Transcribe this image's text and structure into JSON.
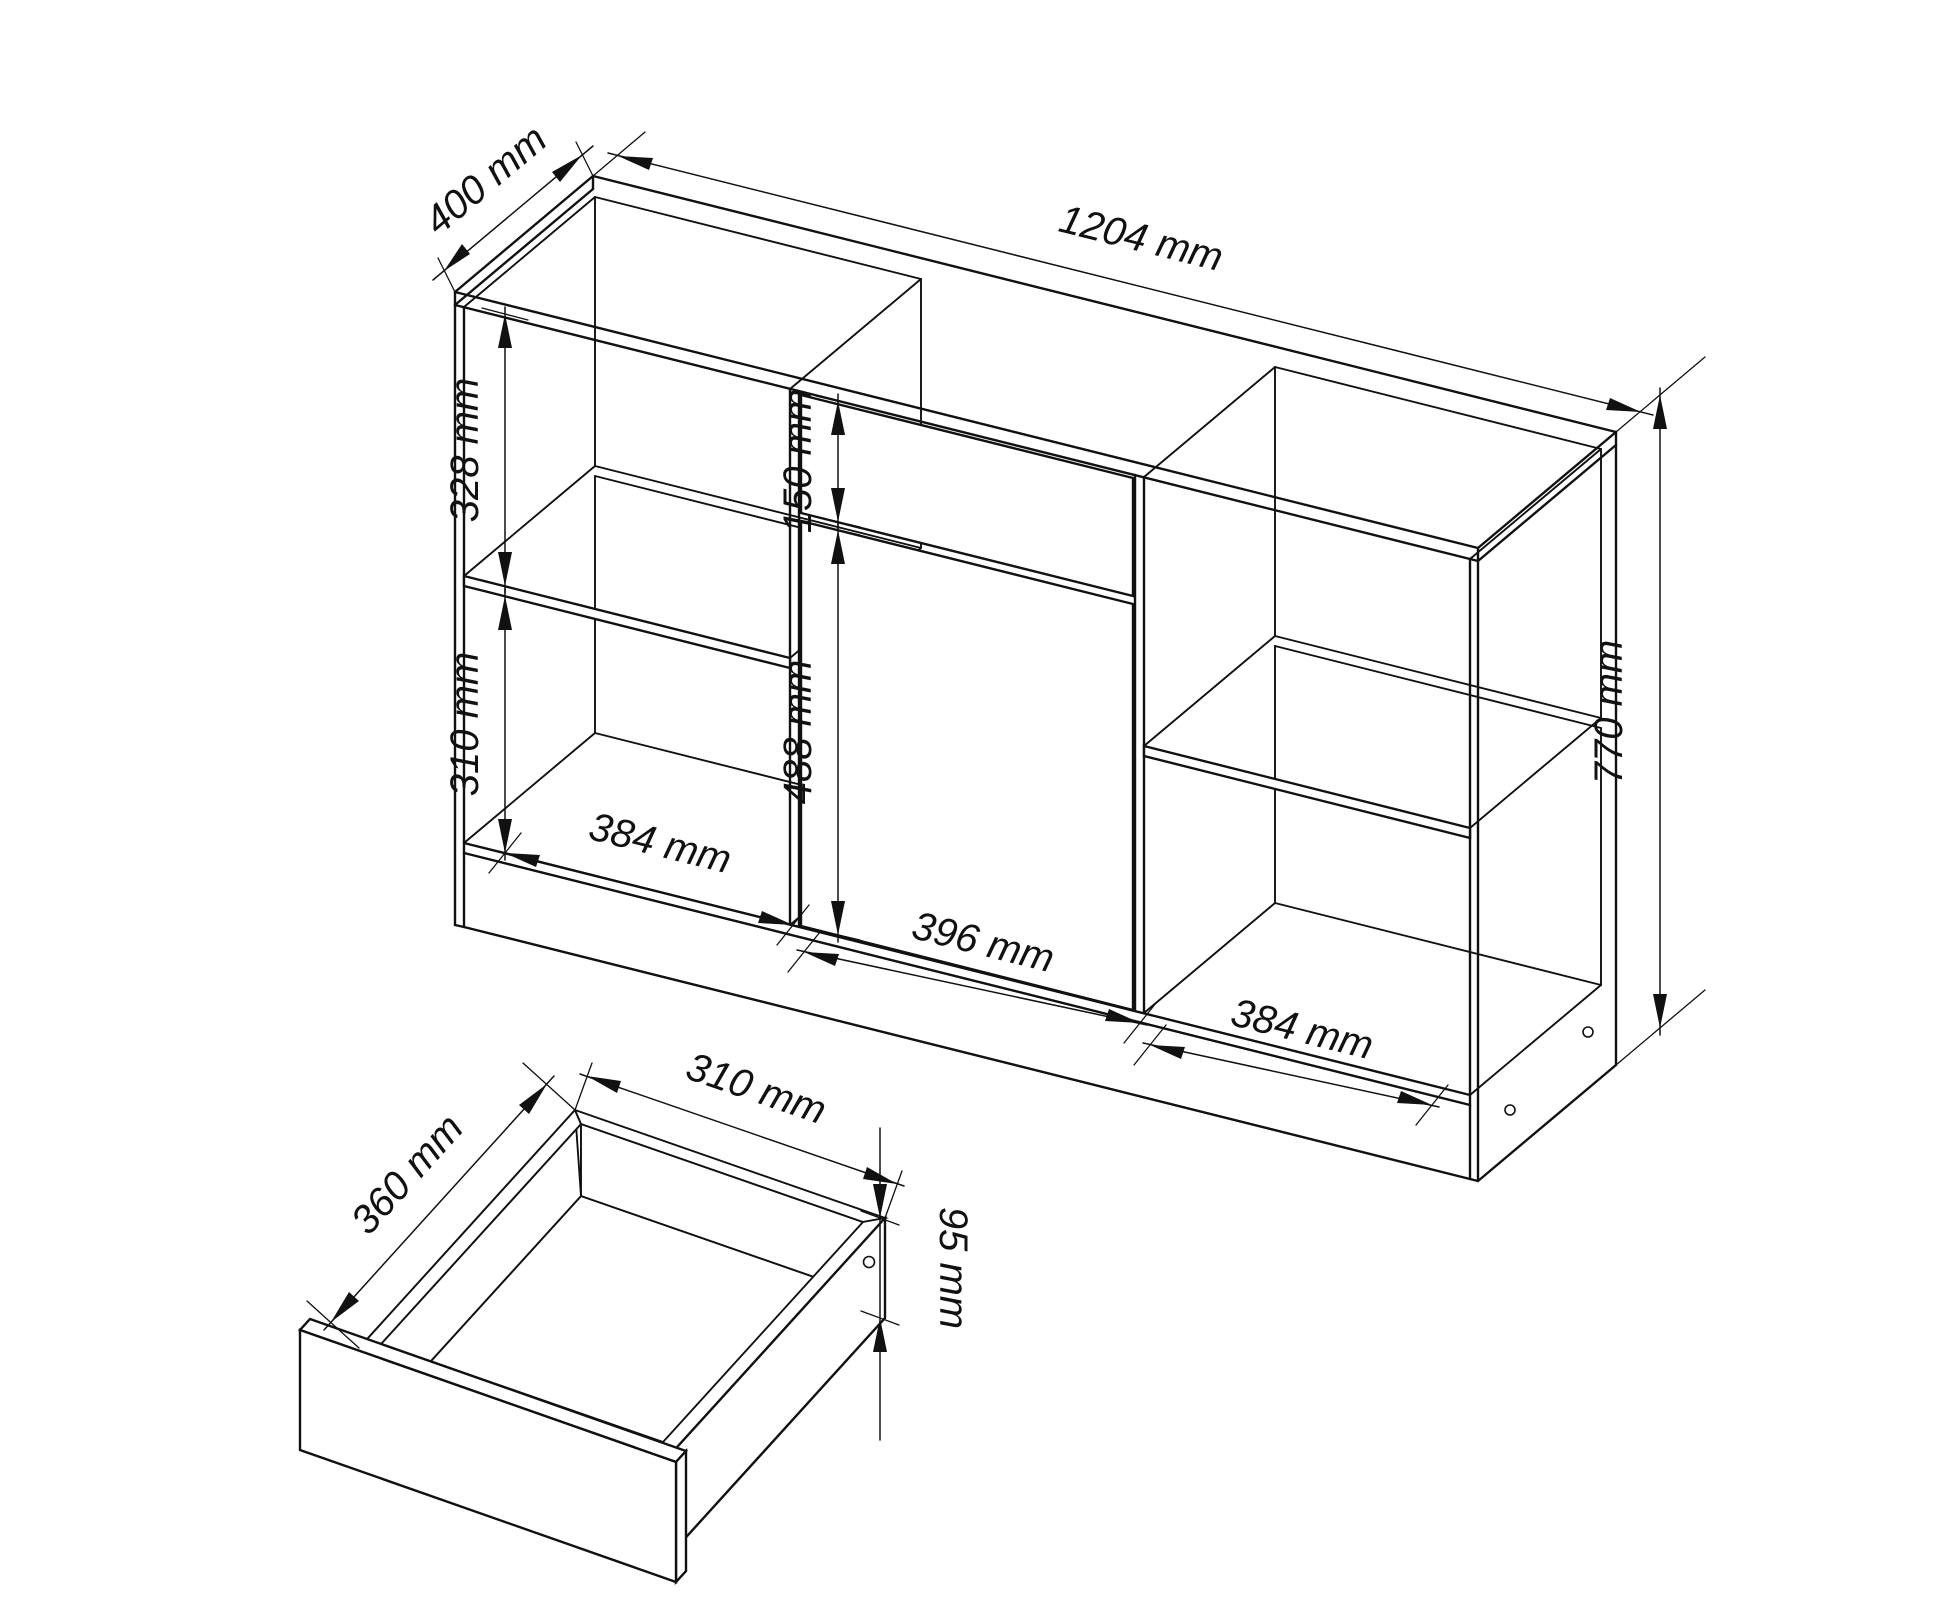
{
  "figure": {
    "type": "furniture-technical-drawing",
    "subject": "sideboard cabinet with open shelves, drawer and door, plus exploded drawer box detail",
    "unit": "mm",
    "colors": {
      "background": "#ffffff",
      "line": "#111111"
    }
  },
  "dimensions": {
    "cabinet_depth": {
      "value": 400,
      "label": "400 mm"
    },
    "cabinet_width": {
      "value": 1204,
      "label": "1204 mm"
    },
    "left_upper_height": {
      "value": 328,
      "label": "328 mm"
    },
    "left_lower_height": {
      "value": 310,
      "label": "310 mm"
    },
    "drawer_front_height": {
      "value": 150,
      "label": "150 mm"
    },
    "door_height": {
      "value": 488,
      "label": "488 mm"
    },
    "left_compartment_width": {
      "value": 384,
      "label": "384 mm"
    },
    "door_width": {
      "value": 396,
      "label": "396 mm"
    },
    "right_compartment_width": {
      "value": 384,
      "label": "384 mm"
    },
    "cabinet_height": {
      "value": 770,
      "label": "770 mm"
    },
    "drawer_depth": {
      "value": 360,
      "label": "360 mm"
    },
    "drawer_width": {
      "value": 310,
      "label": "310 mm"
    },
    "drawer_side_height": {
      "value": 95,
      "label": "95 mm"
    }
  }
}
